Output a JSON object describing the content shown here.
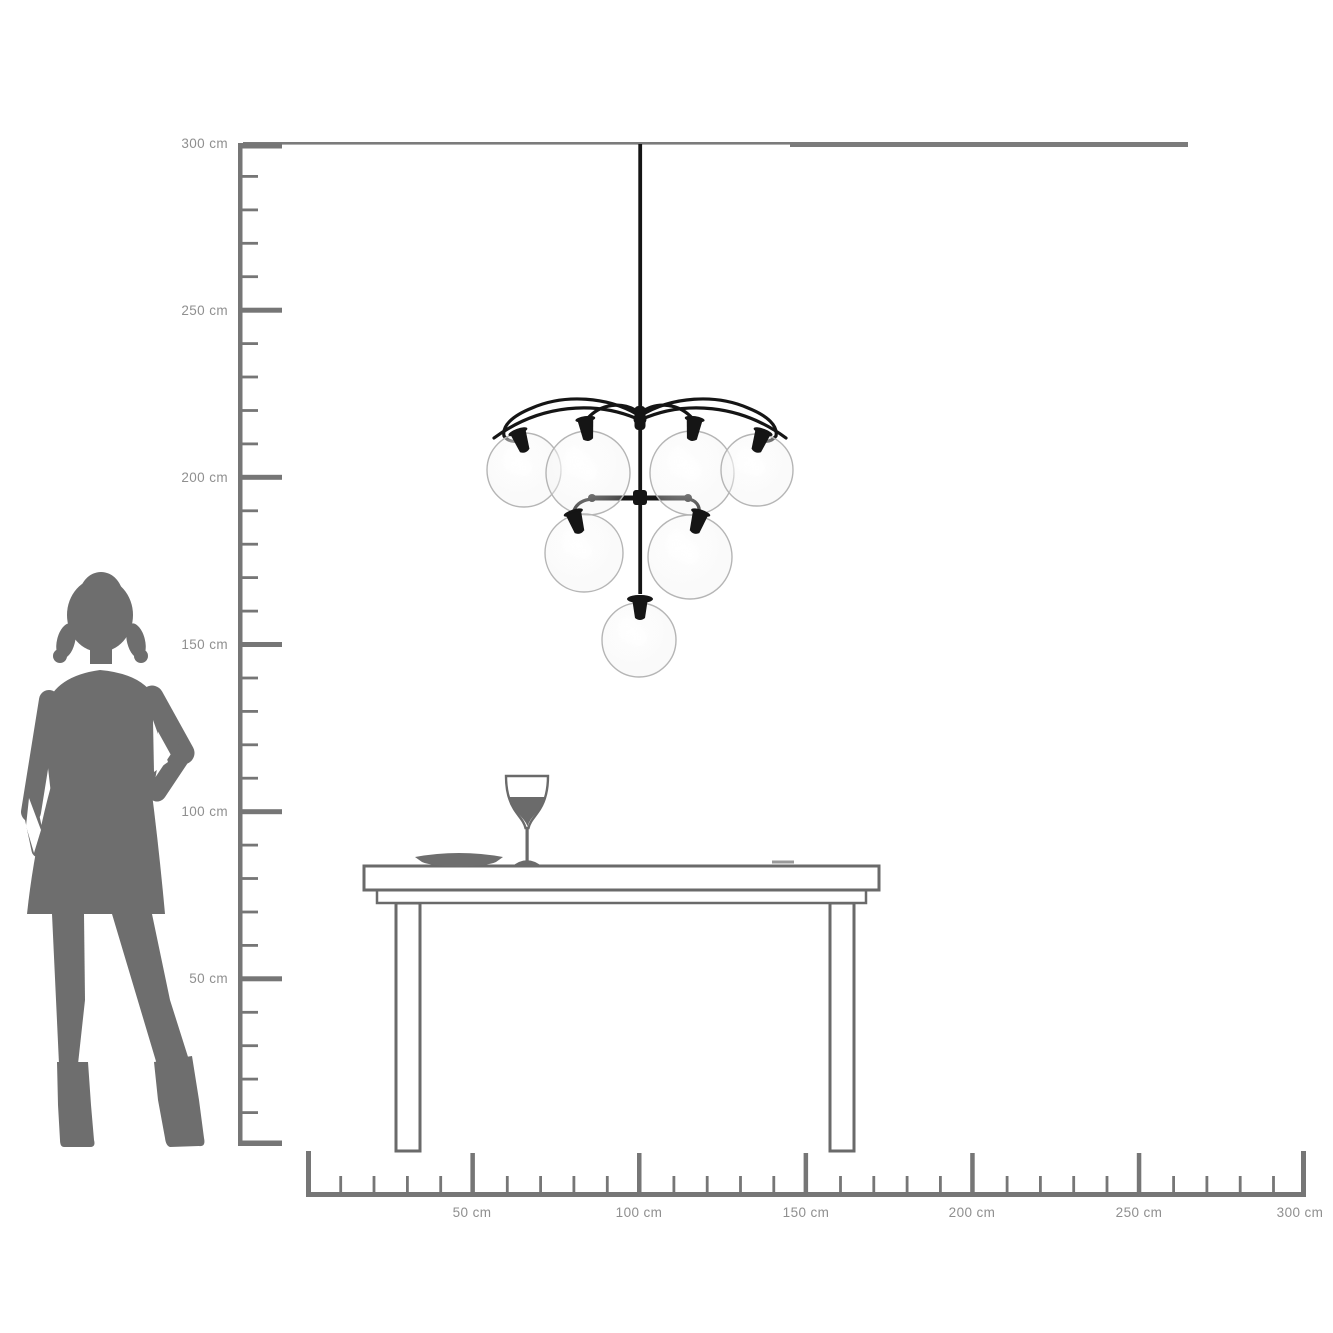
{
  "diagram": {
    "type": "product-dimension-scale-drawing",
    "unit": "cm",
    "rulers": {
      "vertical": {
        "axis": "height",
        "min_cm": 0,
        "max_cm": 300,
        "major_step_cm": 50,
        "minor_step_cm": 10,
        "labels": [
          "300 cm",
          "250 cm",
          "200 cm",
          "150 cm",
          "100 cm",
          "50 cm"
        ]
      },
      "horizontal": {
        "axis": "width",
        "min_cm": 0,
        "max_cm": 300,
        "major_step_cm": 50,
        "minor_step_cm": 10,
        "labels": [
          "50 cm",
          "100 cm",
          "150 cm",
          "200 cm",
          "250 cm",
          "300 cm"
        ]
      }
    },
    "objects": {
      "person": {
        "kind": "woman-silhouette",
        "pose": "standing, hand on hip, boots"
      },
      "lamp": {
        "kind": "pendant-chandelier",
        "globe_count": 7,
        "tiers": [
          4,
          2,
          1
        ],
        "globe_style": "clear glass spheres, black frame"
      },
      "table": {
        "kind": "dining-table",
        "legs_visible": 2
      },
      "tableware": [
        "plate",
        "wine-glass"
      ]
    },
    "colors": {
      "background": "#ffffff",
      "ruler": "#767676",
      "label_text": "#8f8f8f",
      "silhouette": "#6e6e6e",
      "furniture_outline": "#6a6a6a",
      "wine": "#6b6b6b",
      "lamp_frame": "#151515",
      "glass_stroke": "#b5b5b5"
    }
  }
}
